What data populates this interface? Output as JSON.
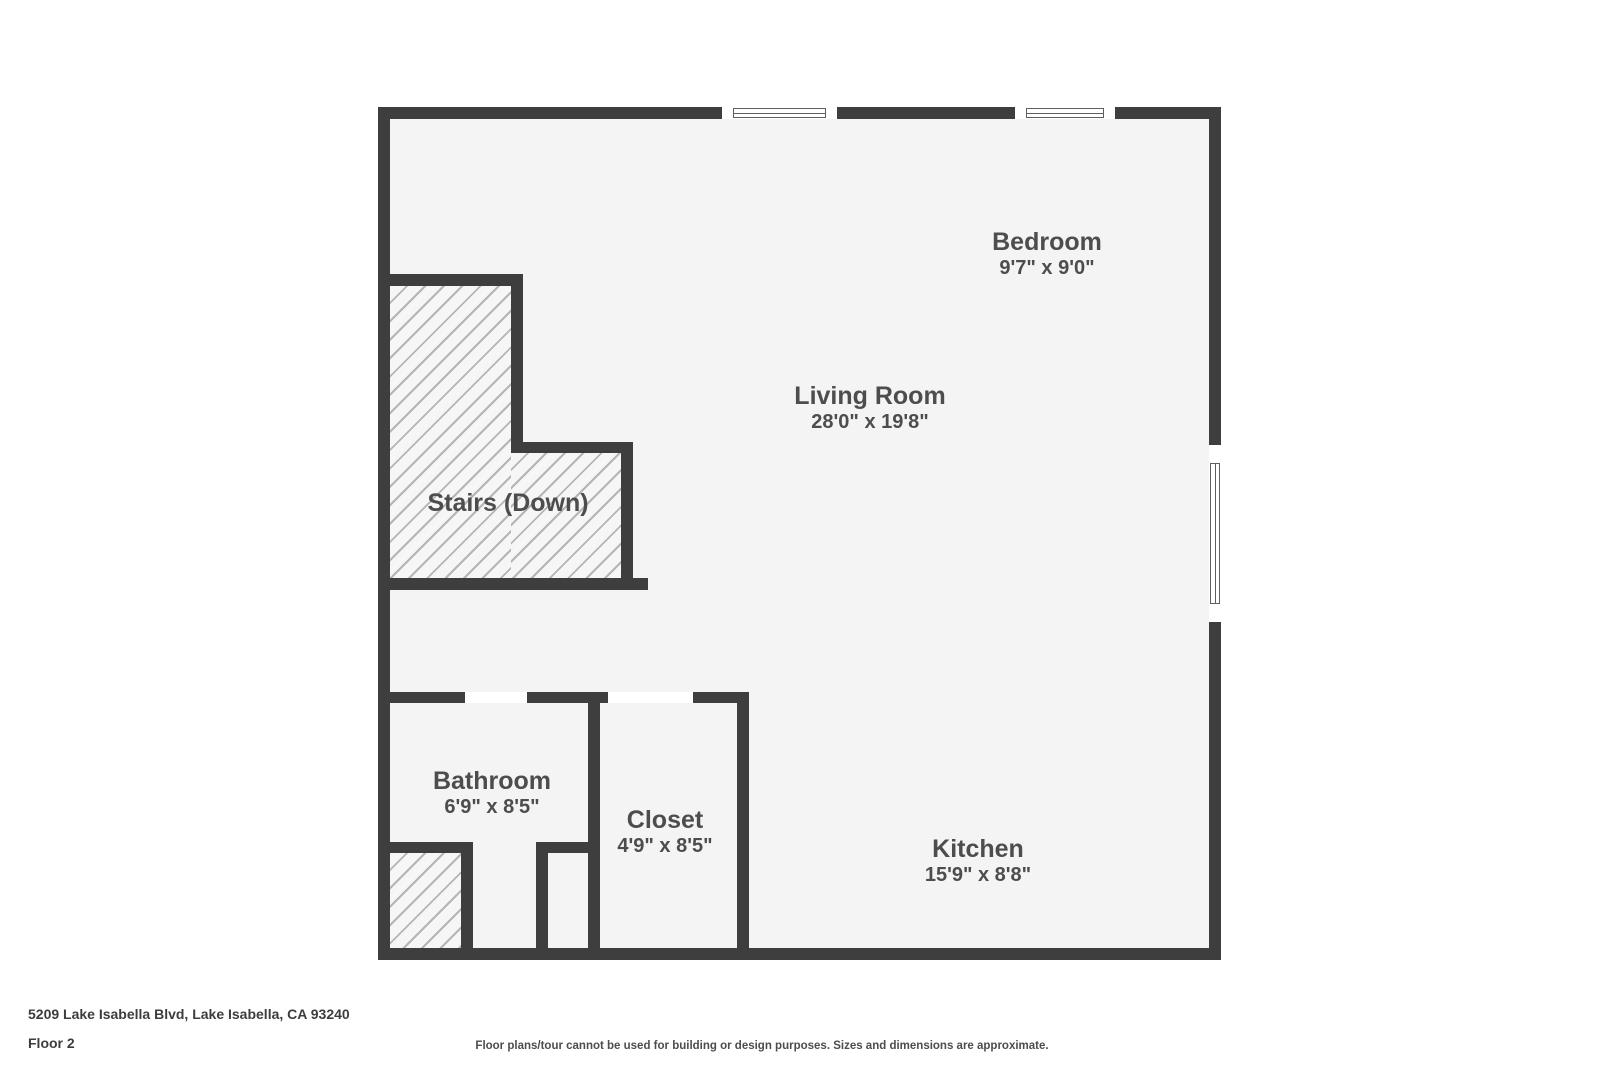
{
  "plan": {
    "wall_color": "#3e3e3e",
    "floor_color": "#f4f4f4",
    "hatch_line_color": "#b5b5b5",
    "hatch_bg_color": "#f6f6f6",
    "opening_color": "#ffffff",
    "label_color": "#4d4d4d"
  },
  "rooms": [
    {
      "name": "Bedroom",
      "dims": "9'7\" x 9'0\""
    },
    {
      "name": "Living Room",
      "dims": "28'0\" x 19'8\""
    },
    {
      "name": "Stairs (Down)",
      "dims": ""
    },
    {
      "name": "Bathroom",
      "dims": "6'9\" x 8'5\""
    },
    {
      "name": "Closet",
      "dims": "4'9\" x 8'5\""
    },
    {
      "name": "Kitchen",
      "dims": "15'9\" x 8'8\""
    }
  ],
  "footer": {
    "address": "5209 Lake Isabella Blvd, Lake Isabella, CA 93240",
    "floor_label": "Floor 2",
    "disclaimer": "Floor plans/tour cannot be used for building or design purposes. Sizes and dimensions are approximate."
  }
}
